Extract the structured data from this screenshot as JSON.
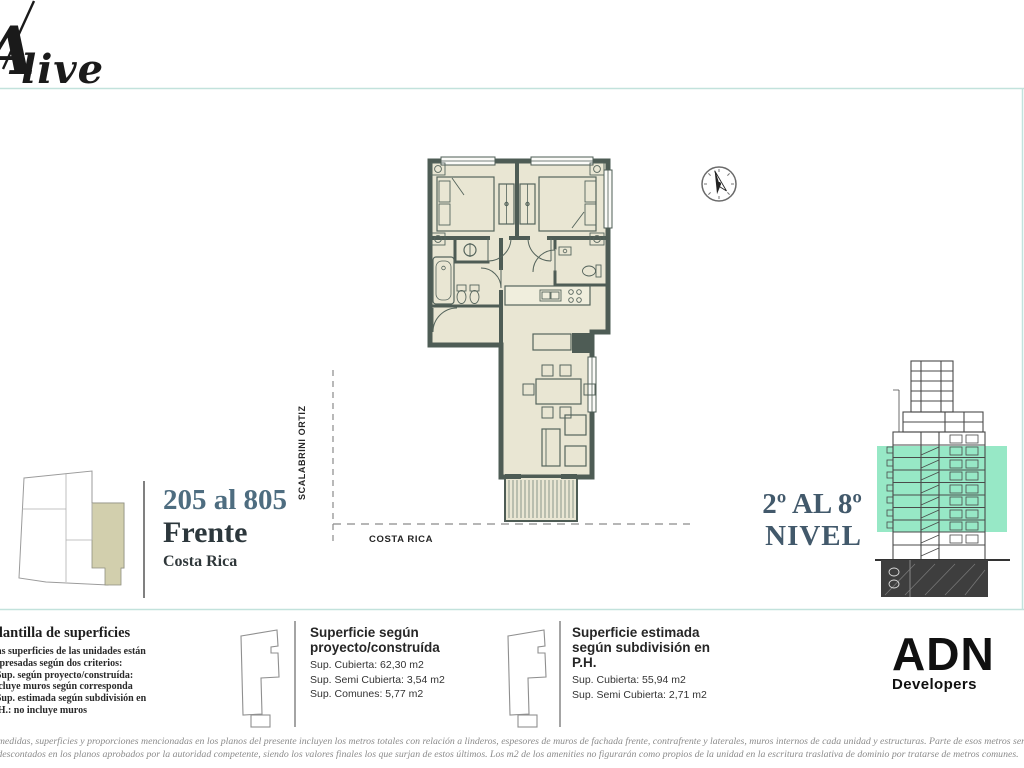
{
  "brand": {
    "letter": "A",
    "word": "live"
  },
  "plan_labels": {
    "street_vertical": "SCALABRINI ORTIZ",
    "street_horizontal": "COSTA RICA"
  },
  "unit": {
    "range": "205 al 805",
    "facing": "Frente",
    "street": "Costa Rica"
  },
  "level": {
    "line1": "2º AL 8º",
    "line2": "NIVEL"
  },
  "legend": {
    "title": "Plantilla de superficies",
    "body": [
      "Las superficies de las unidades están",
      "expresadas según dos criterios:",
      "- Sup. según proyecto/construída:",
      "incluye muros según corresponda",
      "- Sup. estimada según subdivisión en",
      "P.H.: no incluye muros"
    ]
  },
  "surface_project": {
    "title": [
      "Superficie según",
      "proyecto/construída"
    ],
    "items": [
      "Sup. Cubierta: 62,30 m2",
      "Sup. Semi Cubierta: 3,54 m2",
      "Sup. Comunes: 5,77 m2"
    ]
  },
  "surface_ph": {
    "title": [
      "Superficie estimada",
      "según subdivisión en",
      "P.H."
    ],
    "items": [
      "Sup. Cubierta: 55,94 m2",
      "Sup. Semi Cubierta: 2,71 m2"
    ]
  },
  "developer": {
    "name": "ADN",
    "tagline": "Developers"
  },
  "disclaimer": {
    "line1": "Las medidas, superficies y proporciones mencionadas en los planos del presente incluyen los metros totales con relación a linderos, espesores de muros de fachada frente, contrafrente y laterales, muros internos de cada unidad y estructuras. Parte de esos metros serán",
    "line2": "descontados en los planos aprobados por la autoridad competente, siendo los valores finales los que surjan de estos últimos.  Los m2 de los amenities no figurarán como propios de la unidad en la escritura traslativa de dominio por tratarse de metros comunes."
  },
  "colors": {
    "wall": "#4e5c55",
    "floor": "#e9e6d3",
    "highlight_mint": "#97e8c6",
    "highlight_olive": "#d2cfad",
    "accent_blue": "#4e6d80",
    "level_blue": "#42596b",
    "teal_line": "#c2e2dc",
    "fineprint_gray": "#8b8b8b"
  }
}
